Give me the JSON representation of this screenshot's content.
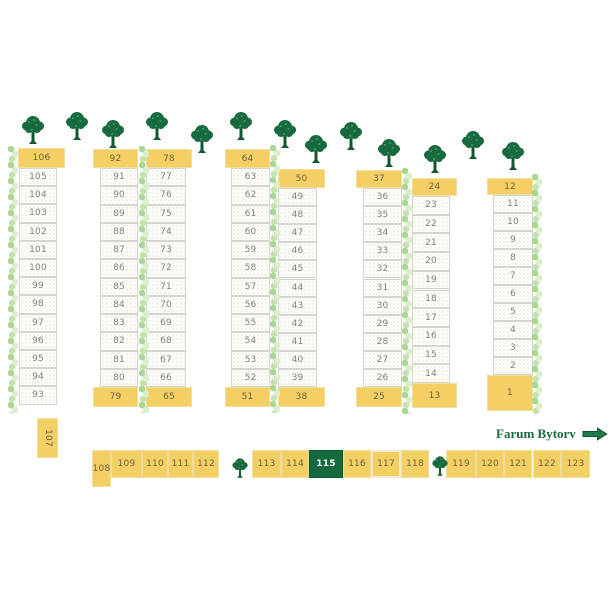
{
  "legend": {
    "label": "Farum Bytorv",
    "x": 496,
    "y": 426
  },
  "colors": {
    "stall_yellow": "#f4cf63",
    "stall_highlight_green": "#156a3d",
    "tree_green": "#176b3e",
    "hedge_light_green": "#c2e2ae",
    "legend_text_green": "#1a6b3e",
    "cell_white": "#fcfcf8"
  },
  "columns": [
    {
      "header": {
        "label": "106",
        "x": 18,
        "y": 148,
        "w": 47,
        "h": 20
      },
      "cells": {
        "labels": [
          "105",
          "104",
          "103",
          "102",
          "101",
          "100",
          "99",
          "98",
          "97",
          "96",
          "95",
          "94",
          "93"
        ],
        "x": 19,
        "w": 38,
        "y0": 168,
        "h": 18.2
      },
      "footer": null
    },
    {
      "header": {
        "label": "92",
        "x": 93,
        "y": 149,
        "w": 45,
        "h": 19
      },
      "cells": {
        "labels": [
          "91",
          "90",
          "89",
          "88",
          "87",
          "86",
          "85",
          "84",
          "83",
          "82",
          "81",
          "80"
        ],
        "x": 100,
        "w": 38,
        "y0": 168,
        "h": 18.25
      },
      "footer": {
        "label": "79",
        "x": 93,
        "y": 387,
        "w": 45,
        "h": 20
      }
    },
    {
      "header": {
        "label": "78",
        "x": 146,
        "y": 149,
        "w": 46,
        "h": 19
      },
      "cells": {
        "labels": [
          "77",
          "76",
          "75",
          "74",
          "73",
          "72",
          "71",
          "70",
          "69",
          "68",
          "67",
          "66"
        ],
        "x": 146,
        "w": 40,
        "y0": 168,
        "h": 18.25
      },
      "footer": {
        "label": "65",
        "x": 146,
        "y": 387,
        "w": 46,
        "h": 20
      }
    },
    {
      "header": {
        "label": "64",
        "x": 225,
        "y": 149,
        "w": 45,
        "h": 19
      },
      "cells": {
        "labels": [
          "63",
          "62",
          "61",
          "60",
          "59",
          "58",
          "57",
          "56",
          "55",
          "54",
          "53",
          "52"
        ],
        "x": 231,
        "w": 39,
        "y0": 168,
        "h": 18.25
      },
      "footer": {
        "label": "51",
        "x": 225,
        "y": 387,
        "w": 45,
        "h": 20
      }
    },
    {
      "header": {
        "label": "50",
        "x": 278,
        "y": 169,
        "w": 47,
        "h": 19
      },
      "cells": {
        "labels": [
          "49",
          "48",
          "47",
          "46",
          "45",
          "44",
          "43",
          "42",
          "41",
          "40",
          "39"
        ],
        "x": 278,
        "w": 39,
        "y0": 188,
        "h": 18.1
      },
      "footer": {
        "label": "38",
        "x": 278,
        "y": 387,
        "w": 47,
        "h": 20
      }
    },
    {
      "header": {
        "label": "37",
        "x": 356,
        "y": 170,
        "w": 46,
        "h": 18
      },
      "cells": {
        "labels": [
          "36",
          "35",
          "34",
          "33",
          "32",
          "31",
          "30",
          "29",
          "28",
          "27",
          "26"
        ],
        "x": 363,
        "w": 39,
        "y0": 188,
        "h": 18.1
      },
      "footer": {
        "label": "25",
        "x": 356,
        "y": 387,
        "w": 46,
        "h": 20
      }
    },
    {
      "header": {
        "label": "24",
        "x": 412,
        "y": 178,
        "w": 45,
        "h": 18
      },
      "cells": {
        "labels": [
          "23",
          "22",
          "21",
          "20",
          "19",
          "18",
          "17",
          "16",
          "15",
          "14"
        ],
        "x": 412,
        "w": 38,
        "y0": 196,
        "h": 18.7
      },
      "footer": {
        "label": "13",
        "x": 412,
        "y": 383,
        "w": 45,
        "h": 25
      }
    },
    {
      "header": {
        "label": "12",
        "x": 487,
        "y": 178,
        "w": 46,
        "h": 17
      },
      "cells": {
        "labels": [
          "11",
          "10",
          "9",
          "8",
          "7",
          "6",
          "5",
          "4",
          "3",
          "2"
        ],
        "x": 493,
        "w": 40,
        "y0": 195,
        "h": 18
      },
      "footer": {
        "label": "1",
        "x": 487,
        "y": 375,
        "w": 46,
        "h": 36
      }
    }
  ],
  "stall_107": {
    "label": "107",
    "x": 37,
    "y": 418,
    "w": 21,
    "h": 40
  },
  "bottom_row": [
    {
      "label": "108",
      "x": 92,
      "y": 450,
      "w": 19,
      "h": 37
    },
    {
      "label": "109",
      "x": 111,
      "y": 450,
      "w": 31,
      "h": 28
    },
    {
      "label": "110",
      "x": 142,
      "y": 450,
      "w": 26,
      "h": 28
    },
    {
      "label": "111",
      "x": 168,
      "y": 450,
      "w": 25,
      "h": 28
    },
    {
      "label": "112",
      "x": 193,
      "y": 450,
      "w": 26,
      "h": 28
    },
    {
      "label": "113",
      "x": 252,
      "y": 450,
      "w": 29,
      "h": 28
    },
    {
      "label": "114",
      "x": 281,
      "y": 450,
      "w": 28,
      "h": 28
    },
    {
      "label": "115",
      "x": 309,
      "y": 450,
      "w": 34,
      "h": 28,
      "highlight": true
    },
    {
      "label": "116",
      "x": 343,
      "y": 450,
      "w": 28,
      "h": 28
    },
    {
      "label": "117",
      "x": 371,
      "y": 450,
      "w": 30,
      "h": 28,
      "light": true
    },
    {
      "label": "118",
      "x": 401,
      "y": 450,
      "w": 28,
      "h": 28
    },
    {
      "label": "119",
      "x": 446,
      "y": 450,
      "w": 30,
      "h": 28
    },
    {
      "label": "120",
      "x": 476,
      "y": 450,
      "w": 28,
      "h": 28
    },
    {
      "label": "121",
      "x": 504,
      "y": 450,
      "w": 28,
      "h": 28
    },
    {
      "label": "122",
      "x": 533,
      "y": 450,
      "w": 28,
      "h": 28
    },
    {
      "label": "123",
      "x": 561,
      "y": 450,
      "w": 29,
      "h": 28
    }
  ],
  "hedges": [
    {
      "x": 8,
      "y": 146,
      "h": 267
    },
    {
      "x": 139,
      "y": 146,
      "h": 267
    },
    {
      "x": 270,
      "y": 145,
      "h": 268
    },
    {
      "x": 402,
      "y": 168,
      "h": 246
    },
    {
      "x": 532,
      "y": 174,
      "h": 240
    }
  ],
  "trees_top": [
    {
      "x": 33,
      "y": 115
    },
    {
      "x": 77,
      "y": 111
    },
    {
      "x": 113,
      "y": 119
    },
    {
      "x": 157,
      "y": 111
    },
    {
      "x": 202,
      "y": 124
    },
    {
      "x": 241,
      "y": 111
    },
    {
      "x": 285,
      "y": 119
    },
    {
      "x": 316,
      "y": 134
    },
    {
      "x": 351,
      "y": 121
    },
    {
      "x": 389,
      "y": 138
    },
    {
      "x": 435,
      "y": 144
    },
    {
      "x": 473,
      "y": 130
    },
    {
      "x": 513,
      "y": 141
    }
  ],
  "trees_bottom": [
    {
      "x": 240,
      "y": 456
    },
    {
      "x": 440,
      "y": 454
    }
  ]
}
